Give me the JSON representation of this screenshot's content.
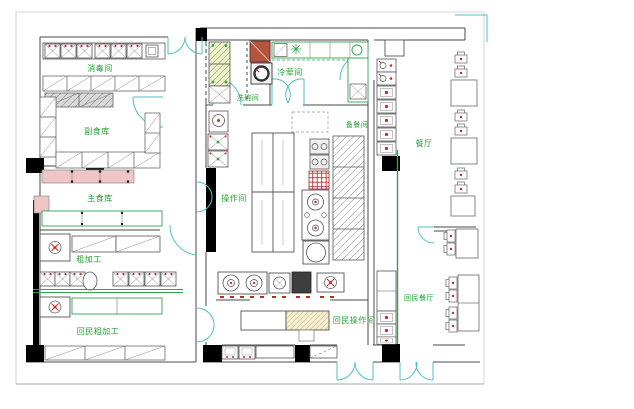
{
  "drawing": {
    "kind": "restaurant-kitchen-floor-plan"
  },
  "labels": {
    "disinfection_room": "消毒间",
    "non_staple_food_storage": "副食库",
    "staple_food_storage": "主食库",
    "rough_processing": "粗加工",
    "hui_rough_processing": "回民粗加工",
    "dishwashing_room": "洗碗间",
    "cold_dish_room": "冷荤间",
    "operation_room": "操作间",
    "food_prep_room": "备餐间",
    "dining_hall": "餐厅",
    "hui_operation_room": "回民操作间",
    "hui_dining_hall": "回民餐厅"
  },
  "colors": {
    "background": "#ffffff",
    "wall_line": "#4a4a4a",
    "label_green": "#1fa332",
    "counter_green": "#2ea44f",
    "door_cyan": "#4cc2c2",
    "fixture_red": "#c22a2a",
    "shelf_pink": "#efc6c6",
    "hatch_yellow_green": "#edf0cd",
    "wood_fill": "#f4eed3",
    "column_black": "#000000",
    "hatch_gray": "#9a9a9a"
  },
  "symbols": [
    "wall",
    "structural-column",
    "door-swing",
    "sink",
    "work-table",
    "shelf-rack",
    "refrigerator",
    "cooking-range",
    "soup-pot",
    "dining-table",
    "chair",
    "service-counter"
  ]
}
